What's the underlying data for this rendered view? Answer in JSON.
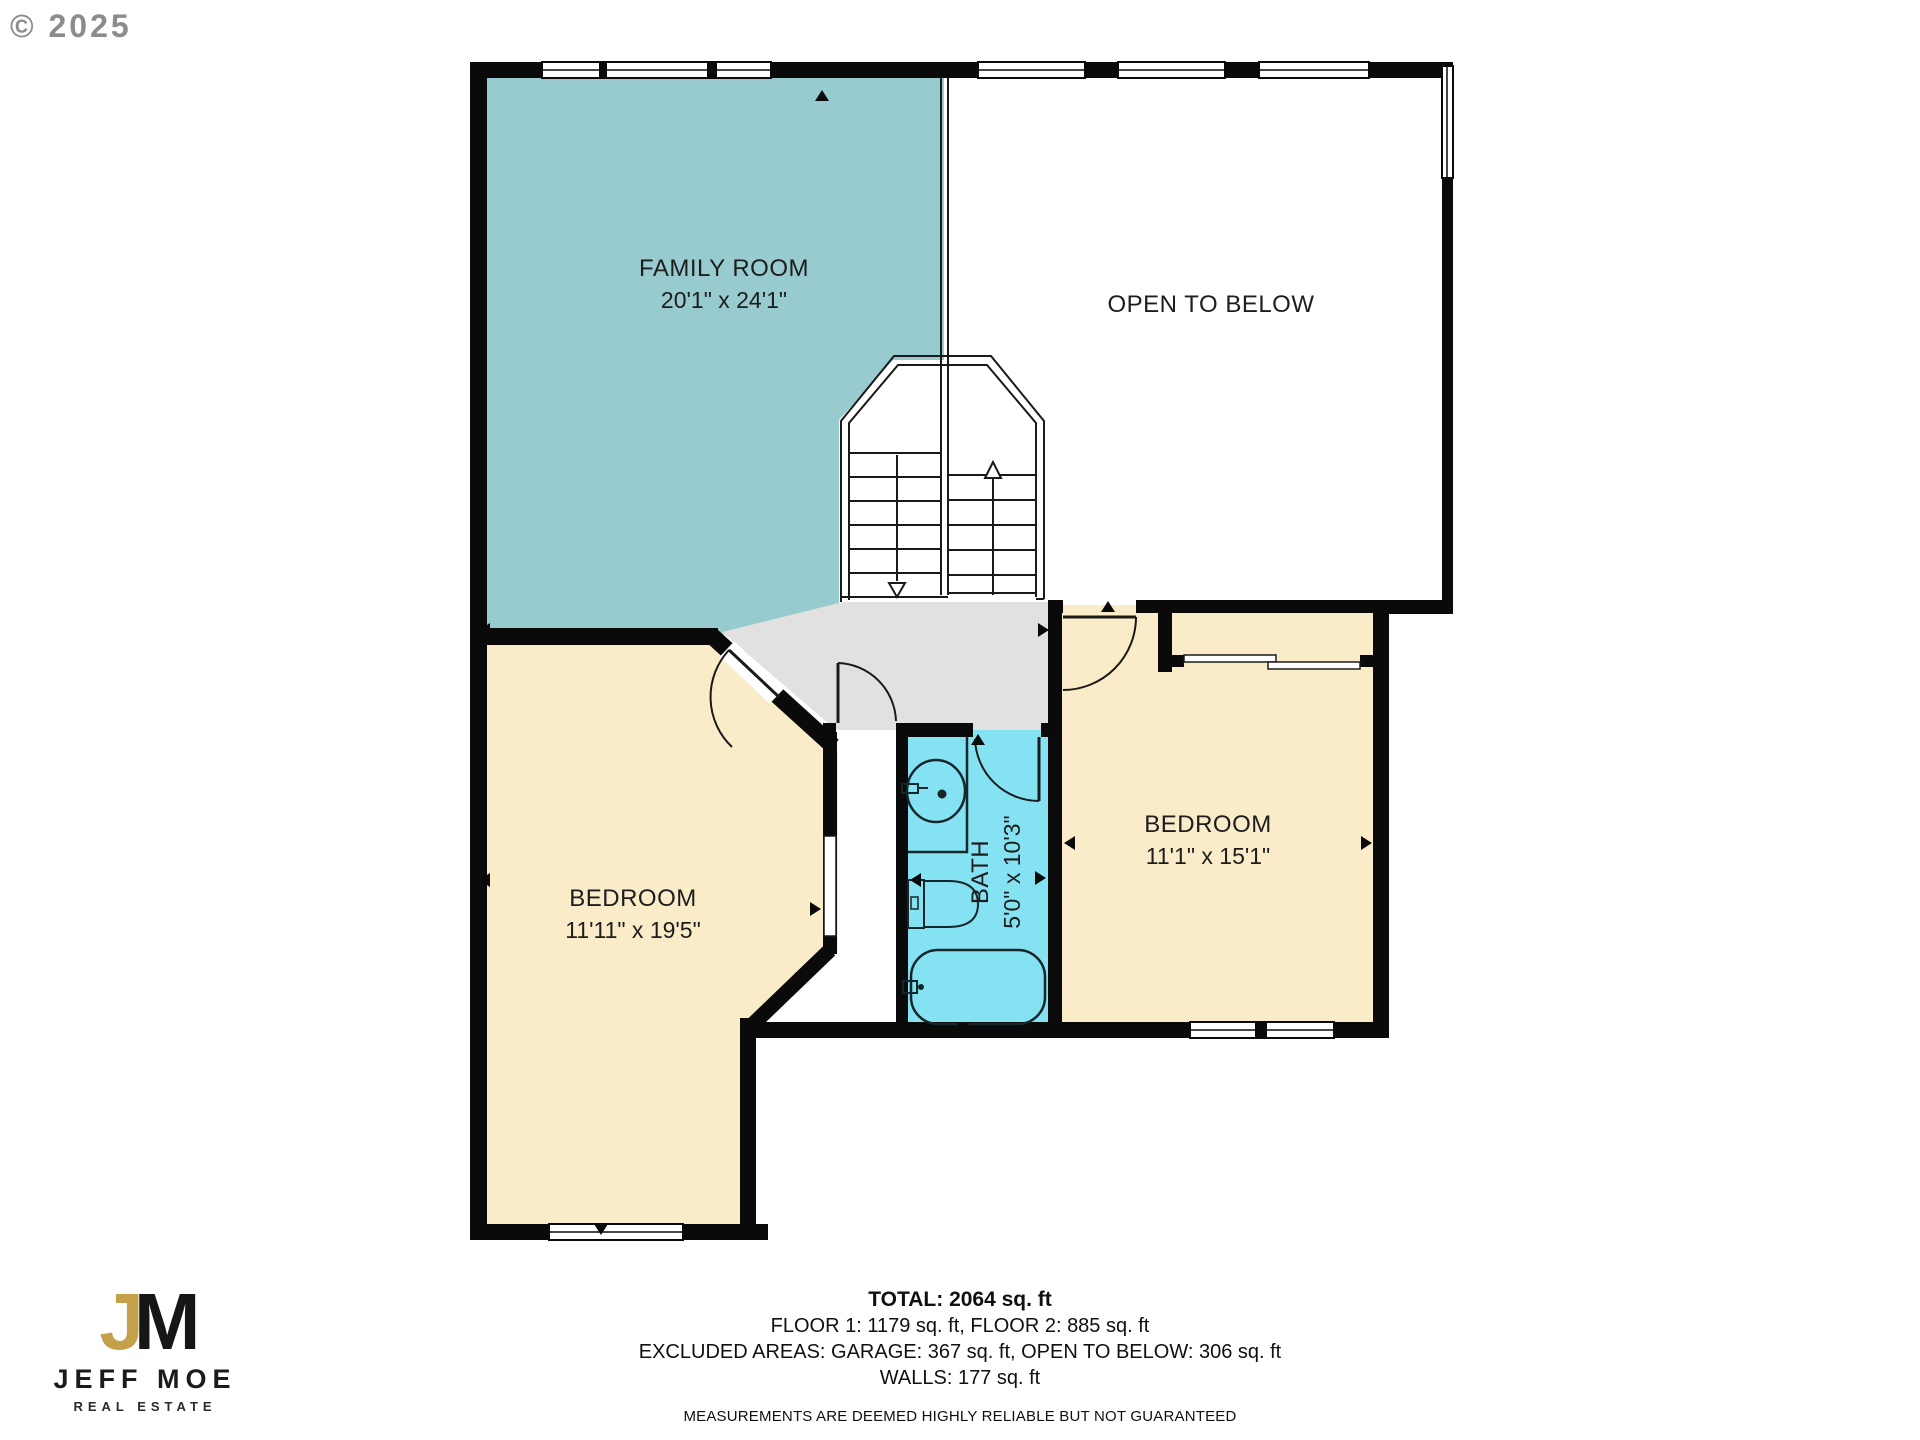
{
  "copyright": "© 2025",
  "rooms": {
    "family_room": {
      "name": "FAMILY ROOM",
      "dims": "20'1\" x 24'1\""
    },
    "open_to_below": {
      "name": "OPEN TO BELOW"
    },
    "bedroom_left": {
      "name": "BEDROOM",
      "dims": "11'11\" x 19'5\""
    },
    "bedroom_right": {
      "name": "BEDROOM",
      "dims": "11'1\" x 15'1\""
    },
    "bath": {
      "name": "BATH",
      "dims": "5'0\" x 10'3\""
    }
  },
  "summary": {
    "total": "TOTAL: 2064 sq. ft",
    "floors": "FLOOR 1: 1179 sq. ft, FLOOR 2: 885 sq. ft",
    "excluded": "EXCLUDED AREAS: GARAGE: 367 sq. ft, OPEN TO BELOW: 306 sq. ft",
    "walls": "WALLS: 177 sq. ft",
    "disclaimer": "MEASUREMENTS ARE DEEMED HIGHLY RELIABLE BUT NOT GUARANTEED"
  },
  "branding": {
    "monogram_j": "J",
    "monogram_m": "M",
    "name": "JEFF MOE",
    "tagline": "REAL ESTATE"
  },
  "colors": {
    "family_room": "#98cbd0",
    "bedroom": "#faecc8",
    "bath": "#85e2f2",
    "hall": "#e1e1e1",
    "wall": "#0a0a0a",
    "gold": "#c5a04a"
  }
}
